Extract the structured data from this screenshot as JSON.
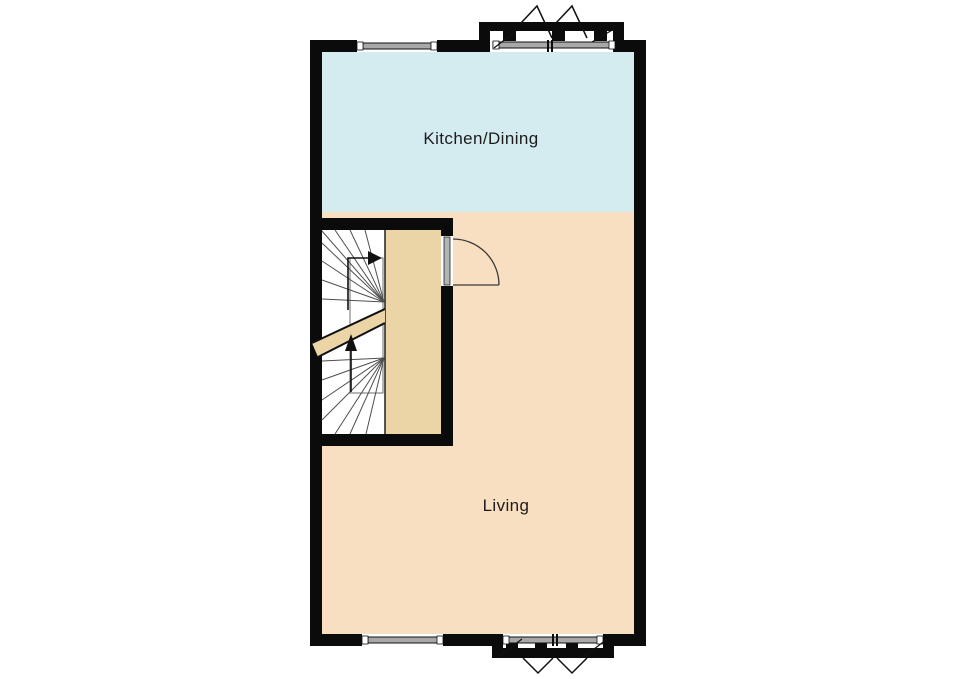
{
  "rooms": {
    "kitchen_dining": {
      "label": "Kitchen/Dining",
      "fill": "#d4ebf0"
    },
    "living": {
      "label": "Living",
      "fill": "#f9dfc1"
    }
  },
  "stairs": {
    "landing_fill": "#ebd5a7",
    "break_band_fill": "#ebd5a7",
    "direction_arrow_icons": [
      "up-arrow",
      "right-arrow"
    ]
  },
  "door": {
    "leaf_fill": "#b3b3b3"
  },
  "colors": {
    "wall": "#0b0b0b",
    "window_glazing": "#a8a8a8",
    "background": "#ffffff"
  }
}
